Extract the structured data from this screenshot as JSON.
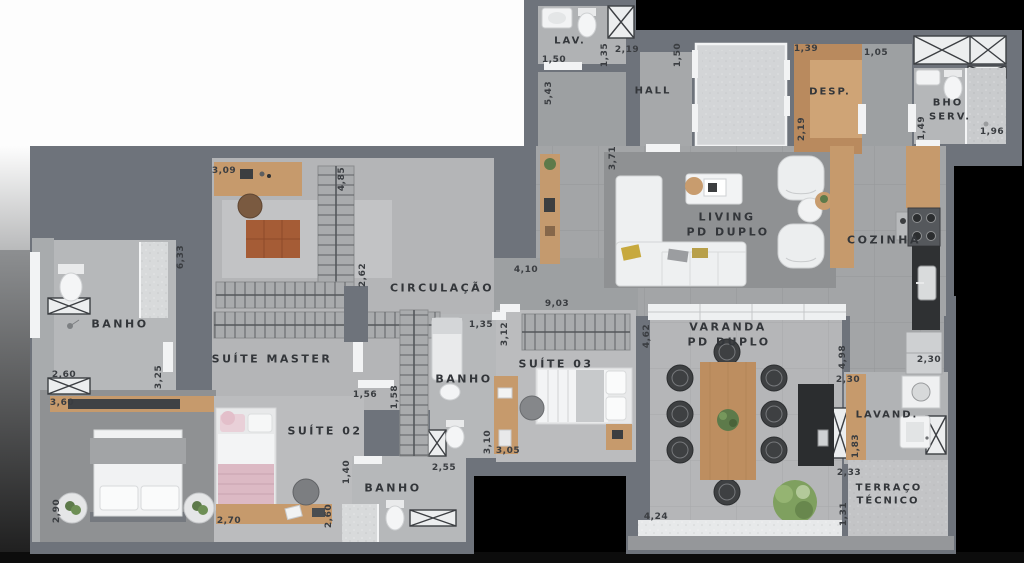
{
  "plan_type": "apartment-floor-plan",
  "rooms": {
    "lav": "LAV.",
    "hall": "HALL",
    "desp": "DESP.",
    "bho_serv_line1": "BHO",
    "bho_serv_line2": "SERV.",
    "living_line1": "LIVING",
    "living_line2": "PD DUPLO",
    "cozinha": "COZINHA",
    "circulacao": "CIRCULAÇÃO",
    "banho_master": "BANHO",
    "suite_master": "SUÍTE MASTER",
    "suite_02": "SUÍTE 02",
    "banho_suite02": "BANHO",
    "banho_social": "BANHO",
    "suite_03": "SUÍTE 03",
    "varanda_line1": "VARANDA",
    "varanda_line2": "PD DUPLO",
    "lavand": "LAVAND.",
    "terraco_line1": "TERRAÇO",
    "terraco_line2": "TÉCNICO"
  },
  "dims": [
    "1,50",
    "1,35",
    "5,43",
    "2,19",
    "1,50",
    "1,39",
    "2,19",
    "1,05",
    "1,49",
    "1,96",
    "3,71",
    "4,10",
    "9,03",
    "2,62",
    "3,09",
    "4,85",
    "6,33",
    "2,60",
    "3,25",
    "3,60",
    "2,90",
    "2,70",
    "2,60",
    "1,56",
    "1,58",
    "1,40",
    "2,55",
    "1,35",
    "3,12",
    "3,10",
    "3,05",
    "4,62",
    "4,98",
    "2,30",
    "2,30",
    "1,83",
    "2,33",
    "1,31",
    "4,24"
  ],
  "colors": {
    "wall": "#6e737b",
    "floor_tile": "#a3a5a7",
    "floor_bedroom": "#bbbcbe",
    "floor_concrete": "#8f9193",
    "wood": "#c69a6c",
    "counter_dark": "#2f3133",
    "fixture_white": "#f2f3f4",
    "plant_green": "#5d7a4a",
    "label_text": "#33363a"
  }
}
